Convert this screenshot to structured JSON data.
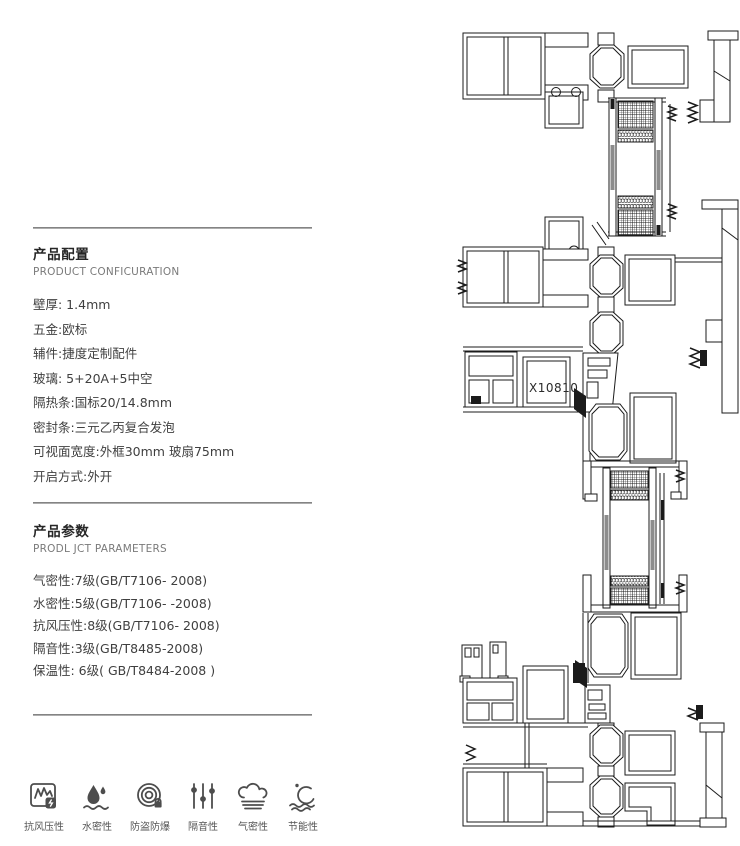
{
  "config_section": {
    "title": "产品配置",
    "subtitle": "PRODUCT CONFICURATION",
    "items": [
      "壁厚: 1.4mm",
      "五金:欧标",
      "辅件:捷度定制配件",
      "玻璃: 5+20A+5中空",
      "隔热条:国标20/14.8mm",
      "密封条:三元乙丙复合发泡",
      "可视面宽度:外框30mm 玻扇75mm",
      "开启方式:外开"
    ]
  },
  "params_section": {
    "title": "产品参数",
    "subtitle": "PRODL JCT PARAMETERS",
    "items": [
      "气密性:7级(GB/T7106- 2008)",
      "水密性:5级(GB/T7106- -2008)",
      "抗风压性:8级(GB/T7106- 2008)",
      "隔音性:3级(GB/T8485-2008)",
      "保温性: 6级( GB/T8484-2008 )"
    ]
  },
  "features": [
    {
      "icon": "wind-pressure-icon",
      "label": "抗风压性"
    },
    {
      "icon": "water-tightness-icon",
      "label": "水密性"
    },
    {
      "icon": "anti-theft-icon",
      "label": "防盗防爆"
    },
    {
      "icon": "sound-insulation-icon",
      "label": "隔音性"
    },
    {
      "icon": "air-tightness-icon",
      "label": "气密性"
    },
    {
      "icon": "energy-saving-icon",
      "label": "节能性"
    }
  ],
  "drawing": {
    "label": "X10810"
  },
  "colors": {
    "ink": "#1b1b1b",
    "text": "#3f3f3f",
    "muted": "#7a7a7a",
    "icon": "#4d4d4d",
    "divider": "#8a8a8a",
    "background": "#ffffff"
  }
}
